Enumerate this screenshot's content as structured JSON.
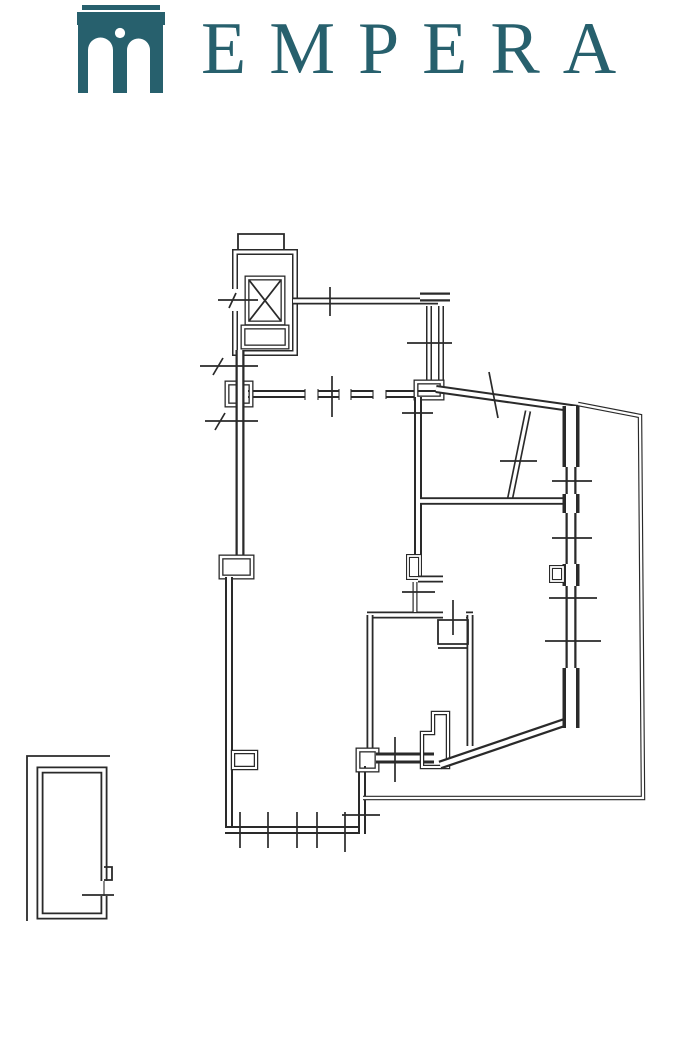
{
  "brand": {
    "name": "EMPERA",
    "color": "#27606d"
  },
  "drawing": {
    "ink": "#2a2a2a",
    "paper": "#ffffff"
  }
}
